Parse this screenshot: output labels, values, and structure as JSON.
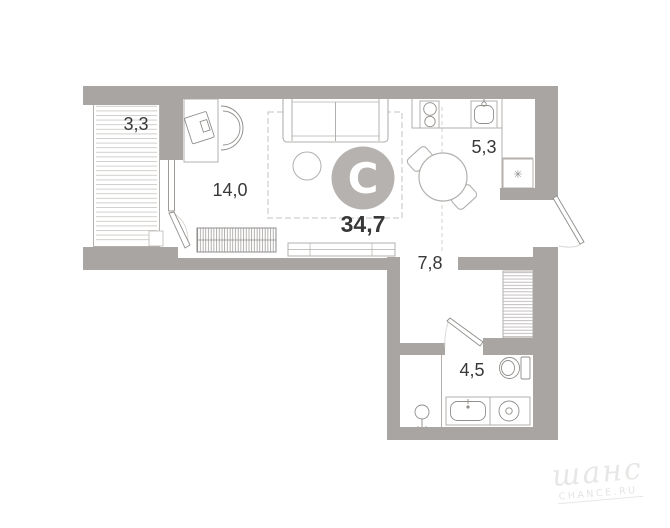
{
  "floor_plan": {
    "total_area": "34,7",
    "rooms": {
      "balcony": {
        "area": "3,3"
      },
      "living_room": {
        "area": "14,0"
      },
      "kitchen": {
        "area": "5,3"
      },
      "hallway": {
        "area": "7,8"
      },
      "bathroom": {
        "area": "4,5"
      }
    },
    "logo_letter": "C",
    "fridge_snowflake_icon": "✳"
  },
  "watermark": {
    "script": "шанс",
    "caption": "CHANCE.RU"
  },
  "colors": {
    "wall": "#a9a5a2",
    "logo-circle": "#b5b2af",
    "label": "#383838",
    "outline": "#b3b0ad",
    "outline-dark": "#918e8b",
    "hatch": "#cdcac7",
    "watermark": "#e9e7e5",
    "watermark2": "#e6e4e2"
  }
}
